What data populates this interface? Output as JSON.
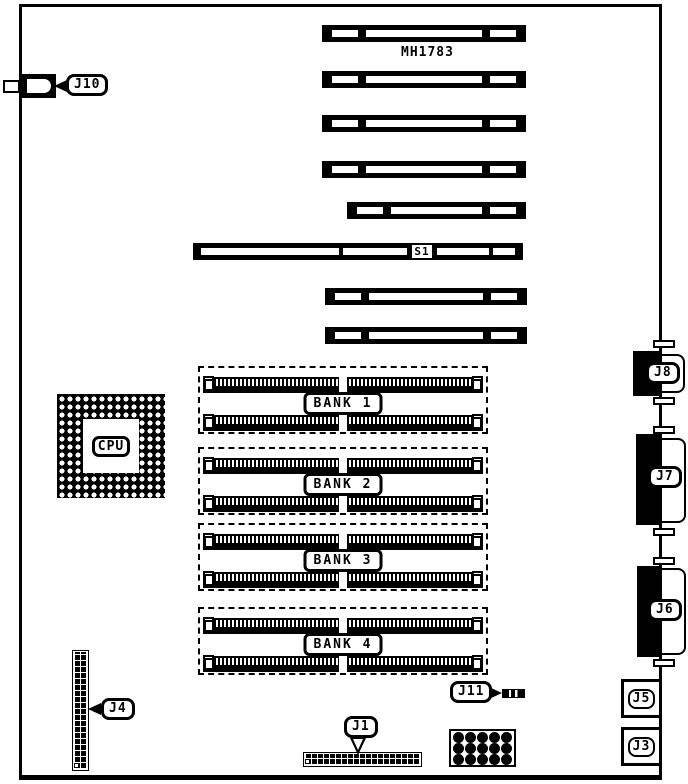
{
  "board": {
    "chip_label": "MH1783",
    "cpu": {
      "label": "CPU"
    },
    "s1": {
      "label": "S1"
    },
    "banks": [
      {
        "label": "BANK 1"
      },
      {
        "label": "BANK 2"
      },
      {
        "label": "BANK 3"
      },
      {
        "label": "BANK 4"
      }
    ],
    "connectors": {
      "j10": {
        "label": "J10"
      },
      "j4": {
        "label": "J4"
      },
      "j1": {
        "label": "J1"
      },
      "j11": {
        "label": "J11"
      },
      "j8": {
        "label": "J8"
      },
      "j7": {
        "label": "J7"
      },
      "j6": {
        "label": "J6"
      },
      "j5": {
        "label": "J5"
      },
      "j3": {
        "label": "J3"
      }
    }
  }
}
